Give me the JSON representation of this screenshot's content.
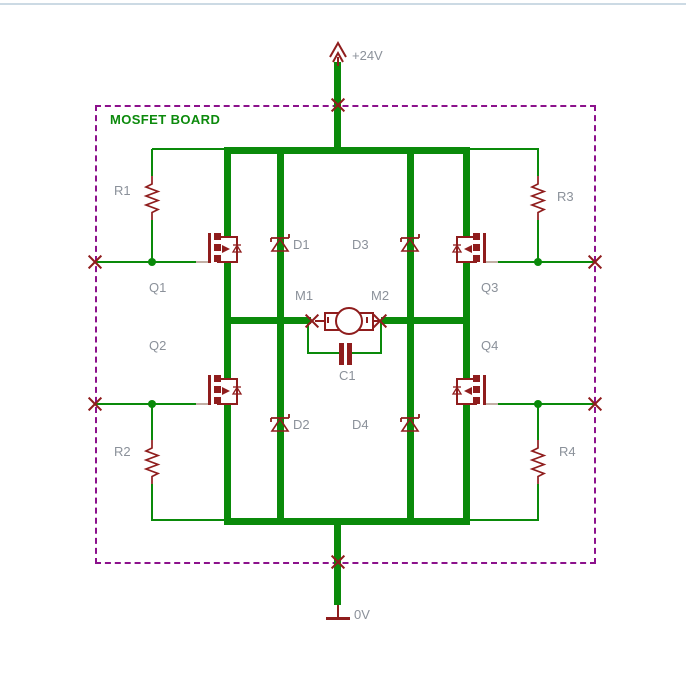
{
  "board": {
    "title": "MOSFET BOARD"
  },
  "nets": {
    "vcc_label": "+24V",
    "gnd_label": "0V"
  },
  "components": {
    "q1": "Q1",
    "q2": "Q2",
    "q3": "Q3",
    "q4": "Q4",
    "r1": "R1",
    "r2": "R2",
    "r3": "R3",
    "r4": "R4",
    "d1": "D1",
    "d2": "D2",
    "d3": "D3",
    "d4": "D4",
    "m1": "M1",
    "m2": "M2",
    "c1": "C1"
  },
  "colors": {
    "wire": "#0a8a0a",
    "symbol": "#8f1d1d",
    "frame": "#8c118c",
    "label": "#8b919a",
    "title": "#0c8a0c",
    "pin": "#c2afa5",
    "topline": "#ccdae4"
  }
}
